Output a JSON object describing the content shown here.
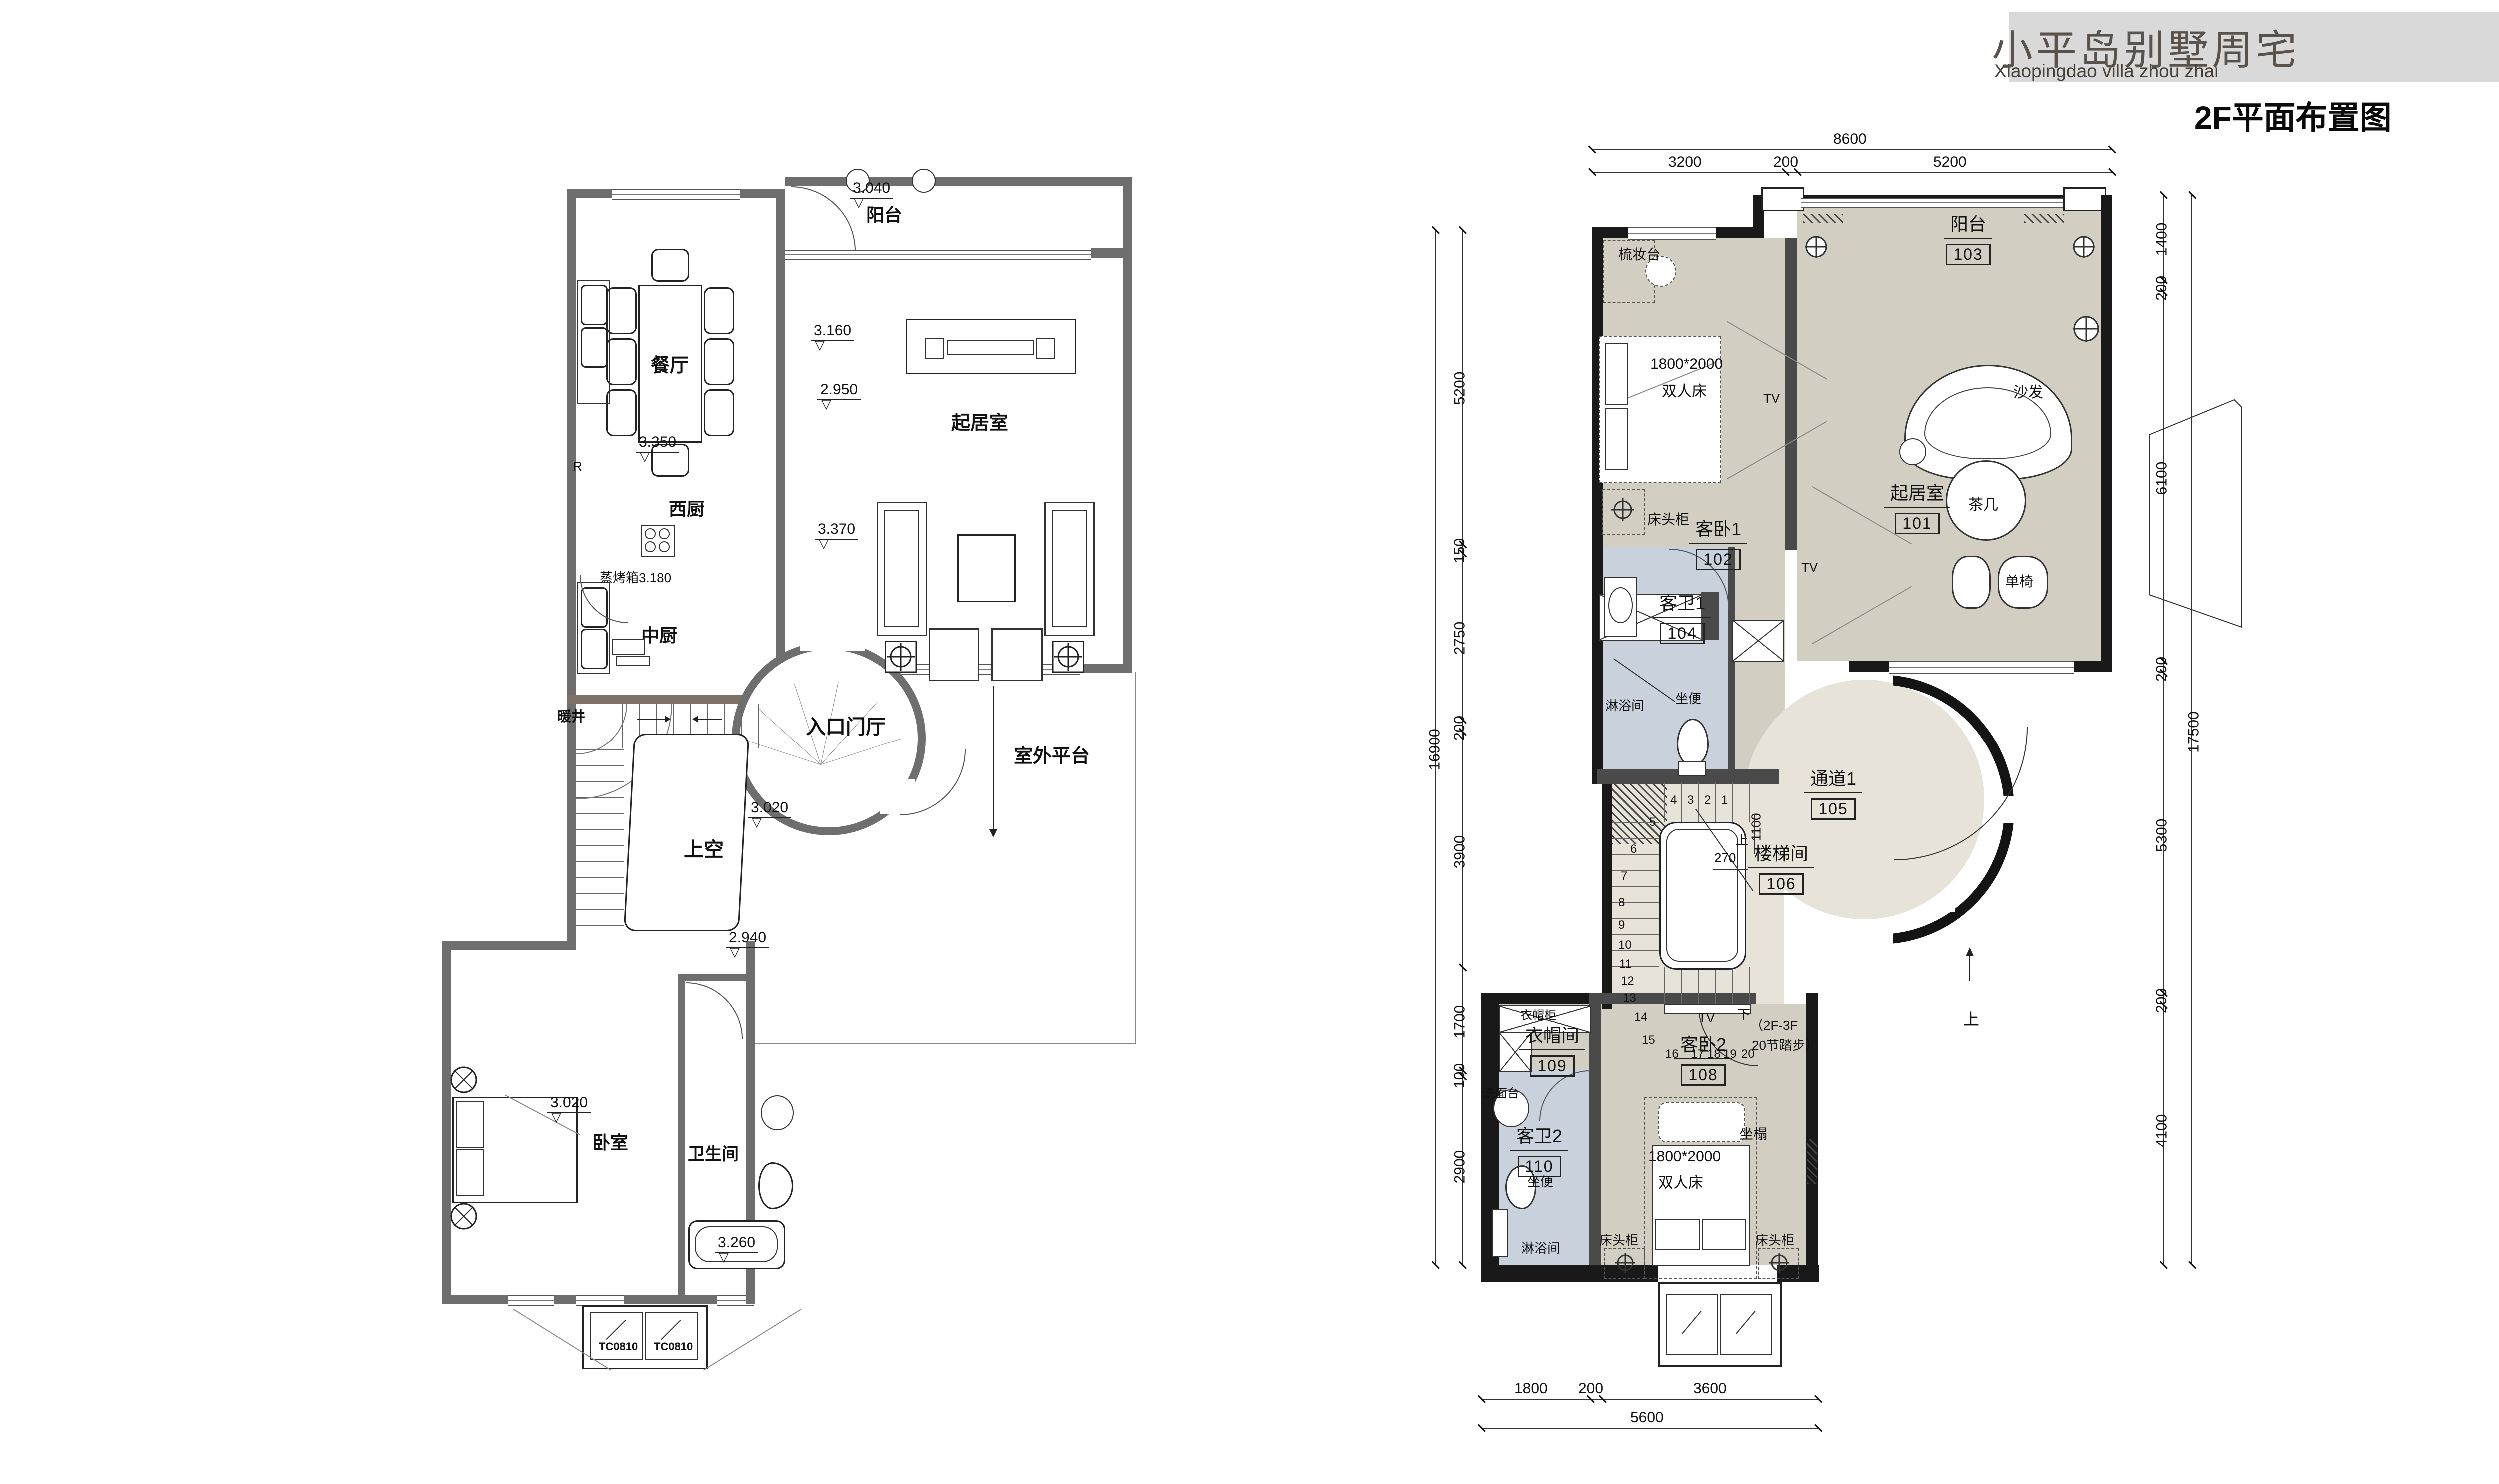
{
  "title_block": {
    "project_cn": "小平岛别墅周宅",
    "project_en": "Xiaopingdao villa zhou zhai",
    "drawing_title": "2F平面布置图"
  },
  "left_plan": {
    "rooms": {
      "balcony": "阳台",
      "dining": "餐厅",
      "west_kitchen": "西厨",
      "chinese_kitchen": "中厨",
      "living": "起居室",
      "entry_hall": "入口门厅",
      "void_above": "上空",
      "shaft": "暖井",
      "outdoor_platform": "室外平台",
      "bedroom": "卧室",
      "bathroom": "卫生间"
    },
    "elevations": {
      "balcony": "3.040",
      "dining_e1": "3.160",
      "dining_e2": "2.950",
      "west_kitchen": "3.350",
      "living": "3.370",
      "steam_oven": "蒸烤箱3.180",
      "entry": "3.020",
      "landing": "2.940",
      "bedroom": "3.020",
      "bath": "3.260"
    },
    "column_mark": "R",
    "windows": {
      "w1": "TC0810",
      "w2": "TC0810"
    }
  },
  "right_plan": {
    "rooms": {
      "living": {
        "name": "起居室",
        "number": "101"
      },
      "bed1": {
        "name": "客卧1",
        "number": "102"
      },
      "balcony": {
        "name": "阳台",
        "number": "103"
      },
      "bath1": {
        "name": "客卫1",
        "number": "104"
      },
      "passage": {
        "name": "通道1",
        "number": "105"
      },
      "stairwell": {
        "name": "楼梯间",
        "number": "106"
      },
      "bed2": {
        "name": "客卧2",
        "number": "108"
      },
      "cloak": {
        "name": "衣帽间",
        "number": "109"
      },
      "bath2": {
        "name": "客卫2",
        "number": "110"
      }
    },
    "furniture": {
      "dressing_table": "梳妆台",
      "bed_size": "1800*2000",
      "double_bed": "双人床",
      "nightstand": "床头柜",
      "tv": "TV",
      "sofa": "沙发",
      "tea_table": "茶几",
      "single_chair": "单椅",
      "shower": "淋浴间",
      "toilet": "坐便",
      "wardrobe_cabinet": "衣帽柜",
      "washstand": "洗面台",
      "bench": "坐榻"
    },
    "stair": {
      "up": "上",
      "down": "下",
      "note1": "（2F-3F",
      "note2": "20节踏步）",
      "dim_270": "270",
      "dim_1100": "1100",
      "numbers": [
        "1",
        "2",
        "3",
        "4",
        "5",
        "6",
        "7",
        "8",
        "9",
        "10",
        "11",
        "12",
        "13",
        "14",
        "15",
        "16",
        "17",
        "18",
        "19",
        "20"
      ]
    },
    "up_arrow_label": "上",
    "dims": {
      "top": {
        "total": "8600",
        "segments": [
          "3200",
          "200",
          "5200"
        ]
      },
      "left": {
        "total": "16900",
        "segments": [
          "5200",
          "150",
          "2750",
          "200",
          "3900",
          "1700",
          "100",
          "2900"
        ]
      },
      "right": {
        "total": "17500",
        "segments": [
          "1400",
          "200",
          "6100",
          "200",
          "5300",
          "200",
          "4100"
        ]
      },
      "bottom": {
        "total": "5600",
        "segments": [
          "1800",
          "200",
          "3600"
        ]
      }
    }
  }
}
